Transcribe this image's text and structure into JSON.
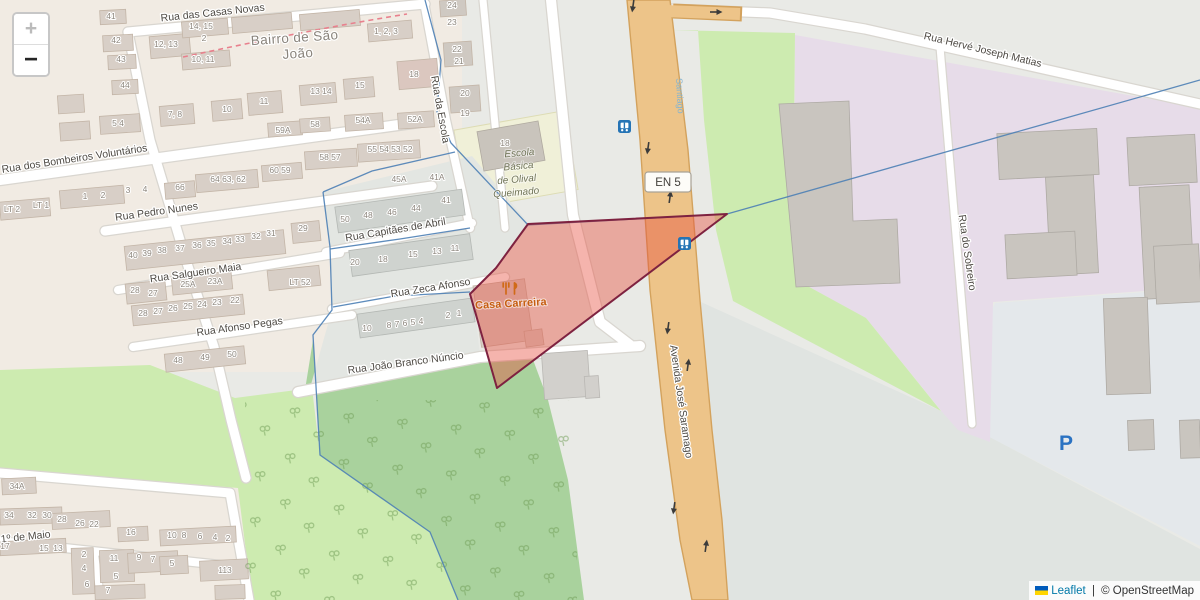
{
  "map": {
    "controls": {
      "zoom_in_label": "+",
      "zoom_out_label": "−"
    },
    "attribution": {
      "flag_icon": "ukraine-flag-icon",
      "leaflet_label": "Leaflet",
      "separator": " | ",
      "osm_label": "© OpenStreetMap"
    },
    "badges": {
      "route_ref": "EN 5"
    },
    "places": {
      "neighbourhood_lines": [
        "Bairro de São",
        "João"
      ],
      "route_name": "Santiago"
    },
    "streets": {
      "casas_novas": "Rua das Casas Novas",
      "bombeiros": "Rua dos Bombeiros Voluntários",
      "pedro_nunes": "Rua Pedro Nunes",
      "salgueiro_maia": "Rua Salgueiro Maia",
      "afonso_pegas": "Rua Afonso Pegas",
      "capitaes_abril": "Rua Capitães de Abril",
      "zeca_afonso": "Rua Zeca Afonso",
      "joao_branco": "Rua João Branco Núncio",
      "rua_escola": "Rua da Escola",
      "primeiro_maio": "1º de Maio",
      "avenida": "Avenida José Saramago",
      "sobreiro": "Rua do Sobreiro",
      "herve": "Rua Hervé Joseph Matias"
    },
    "pois": {
      "restaurant": {
        "name": "Casa Carreira",
        "icon": "fork-knife-icon"
      },
      "school": {
        "building_ref": "18",
        "name_lines": [
          "Escola",
          "Básica",
          "de Olival",
          "Queimado"
        ]
      },
      "parking": {
        "label": "P"
      },
      "bus_stop_icon": "bus-stop-icon"
    },
    "colors": {
      "selection_fill": "#e74c3c",
      "selection_stroke": "#7e2240",
      "boundary_blue": "#4d7fb5",
      "road_orange": "#edc489",
      "link_blue": "#0078A8",
      "transit_blue": "#2574b5",
      "poi_orange": "#c65f11"
    },
    "house_numbers": [
      {
        "t": "41",
        "x": 111,
        "y": 19
      },
      {
        "t": "42",
        "x": 116,
        "y": 43
      },
      {
        "t": "43",
        "x": 121,
        "y": 62
      },
      {
        "t": "44",
        "x": 125,
        "y": 88
      },
      {
        "t": "5  4",
        "x": 118,
        "y": 126
      },
      {
        "t": "12, 13",
        "x": 166,
        "y": 47
      },
      {
        "t": "14, 15",
        "x": 201,
        "y": 29
      },
      {
        "t": "2",
        "x": 204,
        "y": 41
      },
      {
        "t": "10, 11",
        "x": 203,
        "y": 62
      },
      {
        "t": "1, 2, 3",
        "x": 386,
        "y": 34
      },
      {
        "t": "18",
        "x": 414,
        "y": 77
      },
      {
        "t": "24",
        "x": 452,
        "y": 8
      },
      {
        "t": "23",
        "x": 452,
        "y": 25
      },
      {
        "t": "22",
        "x": 457,
        "y": 52
      },
      {
        "t": "21",
        "x": 459,
        "y": 64
      },
      {
        "t": "20",
        "x": 465,
        "y": 96
      },
      {
        "t": "19",
        "x": 465,
        "y": 116
      },
      {
        "t": "7, 8",
        "x": 175,
        "y": 117
      },
      {
        "t": "10",
        "x": 227,
        "y": 112
      },
      {
        "t": "11",
        "x": 264,
        "y": 104
      },
      {
        "t": "13 14",
        "x": 321,
        "y": 94
      },
      {
        "t": "15",
        "x": 360,
        "y": 88
      },
      {
        "t": "59A",
        "x": 283,
        "y": 133
      },
      {
        "t": "58",
        "x": 315,
        "y": 127
      },
      {
        "t": "54A",
        "x": 363,
        "y": 123
      },
      {
        "t": "52A",
        "x": 415,
        "y": 122
      },
      {
        "t": "58 57",
        "x": 330,
        "y": 160
      },
      {
        "t": "55 54 53 52",
        "x": 390,
        "y": 152
      },
      {
        "t": "66",
        "x": 180,
        "y": 190
      },
      {
        "t": "64 63, 62",
        "x": 228,
        "y": 182
      },
      {
        "t": "60 59",
        "x": 280,
        "y": 173
      },
      {
        "t": "LT 2",
        "x": 12,
        "y": 212
      },
      {
        "t": "LT 1",
        "x": 41,
        "y": 208
      },
      {
        "t": "1",
        "x": 85,
        "y": 199
      },
      {
        "t": "2",
        "x": 103,
        "y": 198
      },
      {
        "t": "3",
        "x": 128,
        "y": 193
      },
      {
        "t": "4",
        "x": 145,
        "y": 192
      },
      {
        "t": "40",
        "x": 133,
        "y": 258
      },
      {
        "t": "39",
        "x": 147,
        "y": 256
      },
      {
        "t": "38",
        "x": 162,
        "y": 253
      },
      {
        "t": "37",
        "x": 180,
        "y": 251
      },
      {
        "t": "36",
        "x": 197,
        "y": 248
      },
      {
        "t": "35",
        "x": 211,
        "y": 246
      },
      {
        "t": "34",
        "x": 227,
        "y": 244
      },
      {
        "t": "33",
        "x": 240,
        "y": 242
      },
      {
        "t": "32",
        "x": 256,
        "y": 239
      },
      {
        "t": "31",
        "x": 271,
        "y": 236
      },
      {
        "t": "29",
        "x": 303,
        "y": 231
      },
      {
        "t": "50",
        "x": 345,
        "y": 222
      },
      {
        "t": "48",
        "x": 368,
        "y": 218
      },
      {
        "t": "46",
        "x": 392,
        "y": 215
      },
      {
        "t": "44",
        "x": 416,
        "y": 211
      },
      {
        "t": "41",
        "x": 446,
        "y": 203
      },
      {
        "t": "45A",
        "x": 399,
        "y": 182
      },
      {
        "t": "41A",
        "x": 437,
        "y": 180
      },
      {
        "t": "28",
        "x": 135,
        "y": 293
      },
      {
        "t": "27",
        "x": 153,
        "y": 296
      },
      {
        "t": "25A",
        "x": 188,
        "y": 287
      },
      {
        "t": "23A",
        "x": 215,
        "y": 284
      },
      {
        "t": "LT 52",
        "x": 300,
        "y": 285
      },
      {
        "t": "28",
        "x": 143,
        "y": 316
      },
      {
        "t": "27",
        "x": 158,
        "y": 314
      },
      {
        "t": "26",
        "x": 173,
        "y": 311
      },
      {
        "t": "25",
        "x": 188,
        "y": 309
      },
      {
        "t": "24",
        "x": 202,
        "y": 307
      },
      {
        "t": "23",
        "x": 217,
        "y": 305
      },
      {
        "t": "22",
        "x": 235,
        "y": 303
      },
      {
        "t": "20",
        "x": 355,
        "y": 265
      },
      {
        "t": "18",
        "x": 383,
        "y": 262
      },
      {
        "t": "15",
        "x": 413,
        "y": 257
      },
      {
        "t": "13",
        "x": 437,
        "y": 254
      },
      {
        "t": "11",
        "x": 455,
        "y": 251
      },
      {
        "t": "10",
        "x": 367,
        "y": 331
      },
      {
        "t": "8",
        "x": 389,
        "y": 328
      },
      {
        "t": "7",
        "x": 397,
        "y": 327
      },
      {
        "t": "6",
        "x": 405,
        "y": 326
      },
      {
        "t": "5",
        "x": 413,
        "y": 325
      },
      {
        "t": "4",
        "x": 421,
        "y": 324
      },
      {
        "t": "2",
        "x": 448,
        "y": 318
      },
      {
        "t": "1",
        "x": 459,
        "y": 316
      },
      {
        "t": "48",
        "x": 178,
        "y": 363
      },
      {
        "t": "49",
        "x": 205,
        "y": 360
      },
      {
        "t": "50",
        "x": 232,
        "y": 357
      },
      {
        "t": "34A",
        "x": 17,
        "y": 489
      },
      {
        "t": "34",
        "x": 9,
        "y": 518
      },
      {
        "t": "32",
        "x": 32,
        "y": 518
      },
      {
        "t": "30",
        "x": 47,
        "y": 518
      },
      {
        "t": "28",
        "x": 62,
        "y": 522
      },
      {
        "t": "26",
        "x": 80,
        "y": 526
      },
      {
        "t": "22",
        "x": 94,
        "y": 527
      },
      {
        "t": "16",
        "x": 131,
        "y": 535
      },
      {
        "t": "10",
        "x": 172,
        "y": 538
      },
      {
        "t": "8",
        "x": 184,
        "y": 538
      },
      {
        "t": "6",
        "x": 200,
        "y": 539
      },
      {
        "t": "4",
        "x": 215,
        "y": 540
      },
      {
        "t": "2",
        "x": 228,
        "y": 541
      },
      {
        "t": "17",
        "x": 5,
        "y": 549
      },
      {
        "t": "15",
        "x": 44,
        "y": 551
      },
      {
        "t": "13",
        "x": 58,
        "y": 551
      },
      {
        "t": "2",
        "x": 84,
        "y": 557
      },
      {
        "t": "4",
        "x": 84,
        "y": 571
      },
      {
        "t": "6",
        "x": 87,
        "y": 587
      },
      {
        "t": "7",
        "x": 108,
        "y": 593
      },
      {
        "t": "11",
        "x": 114,
        "y": 561
      },
      {
        "t": "5",
        "x": 116,
        "y": 579
      },
      {
        "t": "9",
        "x": 139,
        "y": 560
      },
      {
        "t": "7",
        "x": 153,
        "y": 562
      },
      {
        "t": "5",
        "x": 172,
        "y": 566
      },
      {
        "t": "113",
        "x": 225,
        "y": 573
      },
      {
        "t": "18",
        "x": 505,
        "y": 146
      }
    ]
  }
}
